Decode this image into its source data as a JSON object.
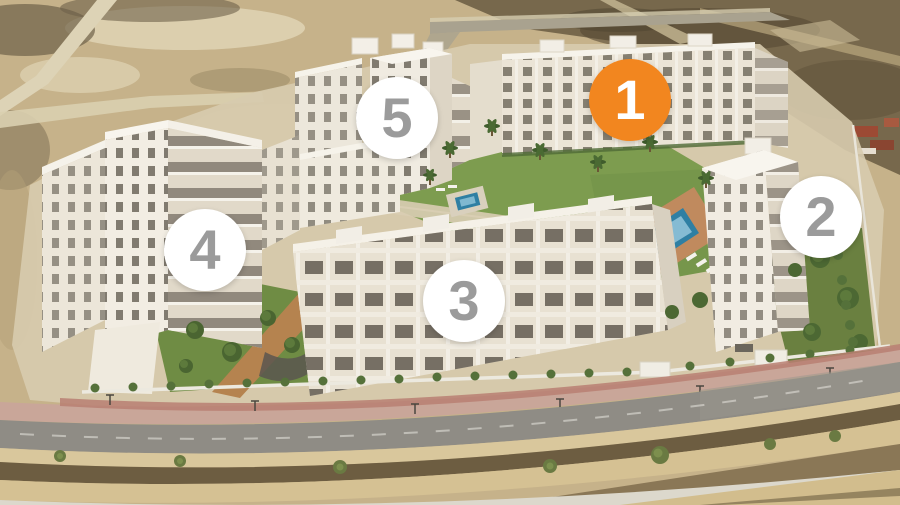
{
  "markers": [
    {
      "label": "1",
      "x": 630,
      "y": 100,
      "bg": "#F2861F",
      "fg": "#FFFFFF",
      "selected": true
    },
    {
      "label": "2",
      "x": 821,
      "y": 217,
      "bg": "#FFFFFF",
      "fg": "#9B9B9B",
      "selected": false
    },
    {
      "label": "3",
      "x": 464,
      "y": 301,
      "bg": "#FFFFFF",
      "fg": "#9B9B9B",
      "selected": false
    },
    {
      "label": "4",
      "x": 205,
      "y": 250,
      "bg": "#FFFFFF",
      "fg": "#9B9B9B",
      "selected": false
    },
    {
      "label": "5",
      "x": 397,
      "y": 118,
      "bg": "#FFFFFF",
      "fg": "#9B9B9B",
      "selected": false
    }
  ],
  "palette": {
    "marker_active_bg": "#F2861F",
    "marker_active_fg": "#FFFFFF",
    "marker_bg": "#FFFFFF",
    "marker_fg": "#9B9B9B",
    "terrain_sand": "#C6B28A",
    "terrain_dark": "#77684C",
    "lawn_green": "#7D9C4F",
    "pool_blue": "#2F7FA3",
    "building_white": "#F0EBE1",
    "road_gray": "#8F8C85",
    "sidewalk_pink": "#C9A699",
    "path_terracotta": "#C08A5E"
  }
}
